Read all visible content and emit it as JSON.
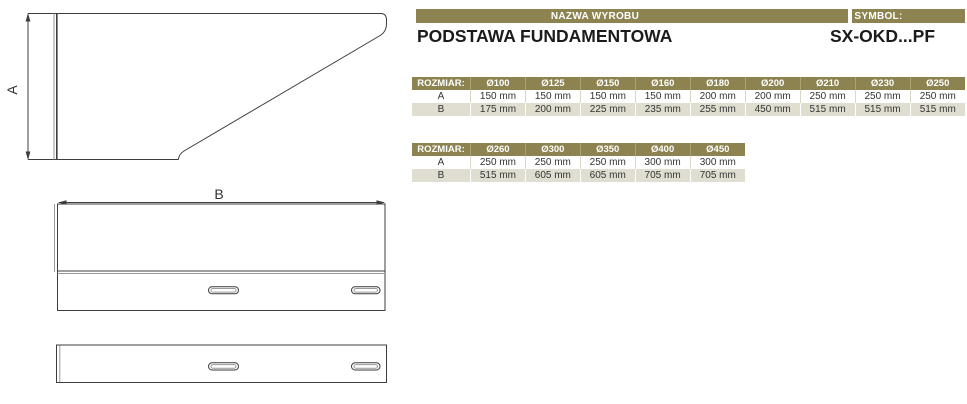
{
  "header": {
    "nazwa_bar": "NAZWA WYROBU",
    "symbol_bar": "SYMBOL:",
    "product_name": "PODSTAWA FUNDAMENTOWA",
    "symbol_value": "SX-OKD...PF"
  },
  "drawing": {
    "dim_a_label": "A",
    "dim_b_label": "B"
  },
  "colors": {
    "accent_olive": "#8C8351",
    "row_beige": "#E0DED0",
    "line": "#3D3D3D"
  },
  "size_table_1": {
    "header": [
      "ROZMIAR:",
      "Ø100",
      "Ø125",
      "Ø150",
      "Ø160",
      "Ø180",
      "Ø200",
      "Ø210",
      "Ø230",
      "Ø250"
    ],
    "rows": [
      {
        "label": "A",
        "values": [
          "150 mm",
          "150 mm",
          "150 mm",
          "150 mm",
          "200 mm",
          "200 mm",
          "250 mm",
          "250 mm",
          "250 mm"
        ]
      },
      {
        "label": "B",
        "values": [
          "175 mm",
          "200 mm",
          "225 mm",
          "235 mm",
          "255 mm",
          "450 mm",
          "515 mm",
          "515 mm",
          "515 mm"
        ]
      }
    ]
  },
  "size_table_2": {
    "header": [
      "ROZMIAR:",
      "Ø260",
      "Ø300",
      "Ø350",
      "Ø400",
      "Ø450"
    ],
    "rows": [
      {
        "label": "A",
        "values": [
          "250 mm",
          "250 mm",
          "250 mm",
          "300 mm",
          "300 mm"
        ]
      },
      {
        "label": "B",
        "values": [
          "515 mm",
          "605 mm",
          "605 mm",
          "705 mm",
          "705 mm"
        ]
      }
    ]
  }
}
